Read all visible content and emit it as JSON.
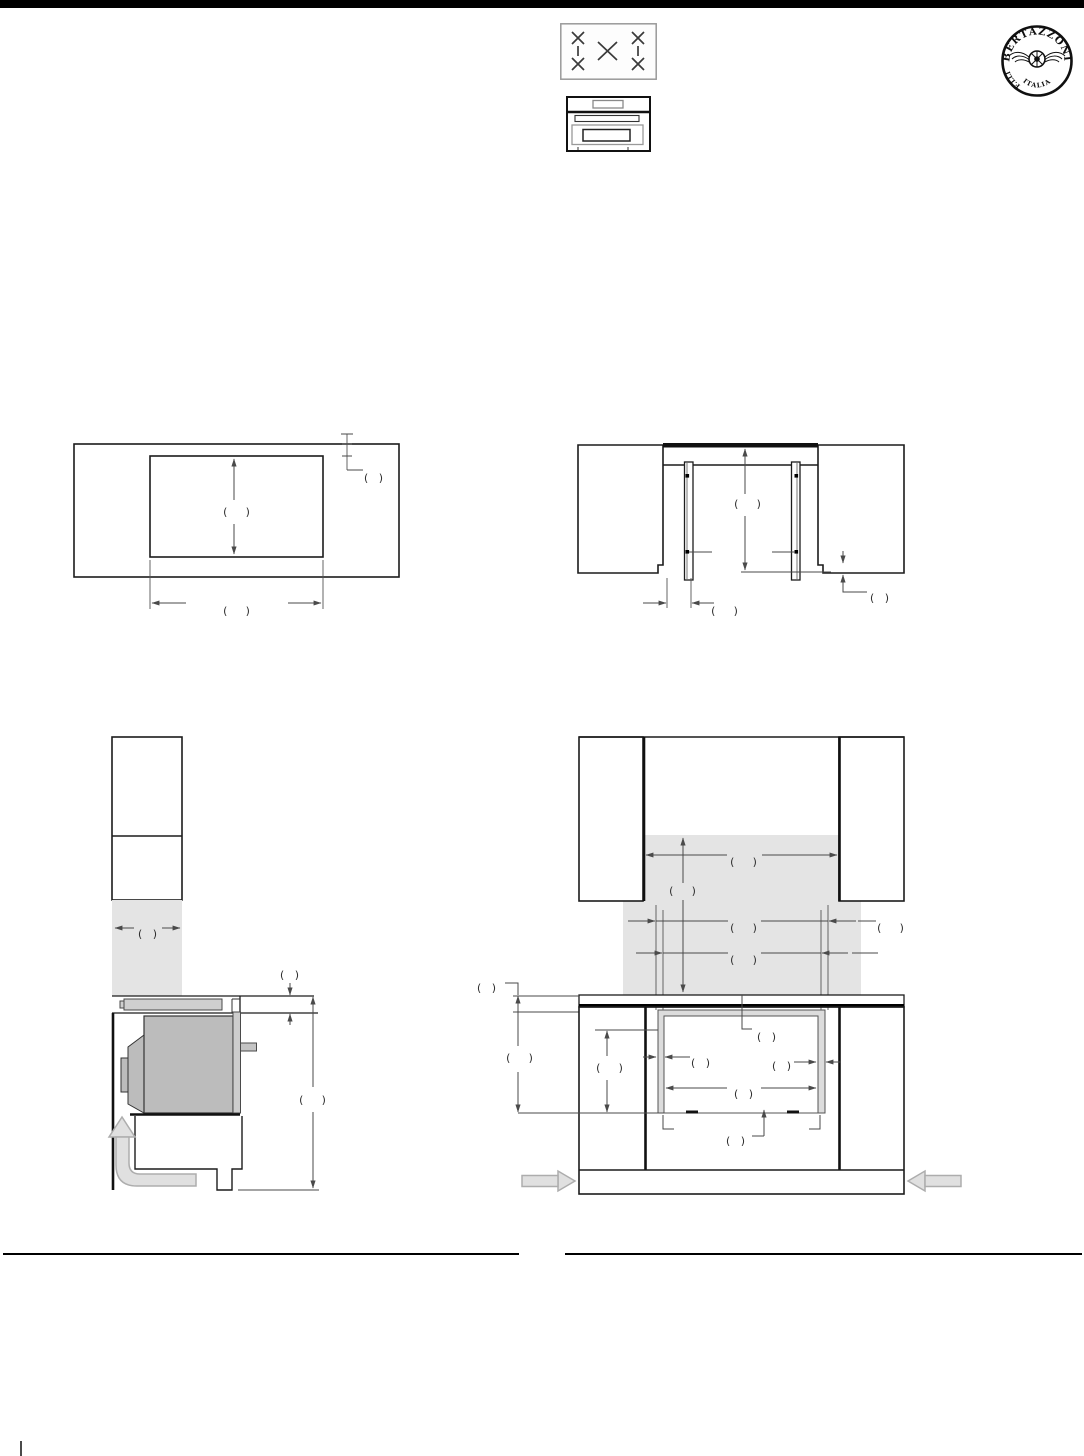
{
  "page": {
    "width": 1084,
    "height": 1456,
    "background": "#ffffff",
    "top_bar_color": "#000000"
  },
  "header": {
    "logo": {
      "prefix": "F.LLI",
      "brand": "BERTAZZONI",
      "country": "ITALIA"
    },
    "icons": [
      {
        "name": "cooktop-5-burner-icon"
      },
      {
        "name": "built-in-oven-icon"
      }
    ]
  },
  "colors": {
    "outline": "#1c1c1c",
    "dimension_line": "#4a4a4a",
    "backsplash_shade": "#e4e4e4",
    "oven_body": "#bcbcbc",
    "rail": "#d8d8d8",
    "niche_frame": "#dcdcdc",
    "airflow_arrow_fill": "#e0e0e0",
    "airflow_arrow_stroke": "#adadad"
  },
  "diagrams": [
    {
      "id": "cutout-top-view",
      "note": "countertop cutout plan view, all dimension values blank"
    },
    {
      "id": "cutout-section-view",
      "note": "cabinet section with mounting rails, all dimension values blank"
    },
    {
      "id": "side-installation-view",
      "note": "side section of oven under cooktop with airflow arrow"
    },
    {
      "id": "front-installation-view",
      "note": "front elevation with niche and airflow arrows"
    }
  ],
  "dimension_labels": [
    {
      "x": 237,
      "y": 512,
      "text": "(  )"
    },
    {
      "x": 237,
      "y": 611,
      "text": "(  )"
    },
    {
      "x": 374,
      "y": 478,
      "text": "( )"
    },
    {
      "x": 748,
      "y": 504,
      "text": "(  )"
    },
    {
      "x": 725,
      "y": 611,
      "text": "(  )"
    },
    {
      "x": 880,
      "y": 598,
      "text": "( )"
    },
    {
      "x": 148,
      "y": 934,
      "text": "( )"
    },
    {
      "x": 290,
      "y": 975,
      "text": "( )"
    },
    {
      "x": 313,
      "y": 1100,
      "text": "(  )"
    },
    {
      "x": 744,
      "y": 862,
      "text": "(  )"
    },
    {
      "x": 683,
      "y": 891,
      "text": "(  )"
    },
    {
      "x": 744,
      "y": 928,
      "text": "(  )"
    },
    {
      "x": 891,
      "y": 928,
      "text": "(  )"
    },
    {
      "x": 744,
      "y": 960,
      "text": "(  )"
    },
    {
      "x": 487,
      "y": 988,
      "text": "( )"
    },
    {
      "x": 520,
      "y": 1058,
      "text": "(  )"
    },
    {
      "x": 610,
      "y": 1068,
      "text": "(  )"
    },
    {
      "x": 767,
      "y": 1037,
      "text": "( )"
    },
    {
      "x": 701,
      "y": 1063,
      "text": "( )"
    },
    {
      "x": 782,
      "y": 1066,
      "text": "( )"
    },
    {
      "x": 744,
      "y": 1094,
      "text": "( )"
    },
    {
      "x": 736,
      "y": 1141,
      "text": "( )"
    }
  ]
}
